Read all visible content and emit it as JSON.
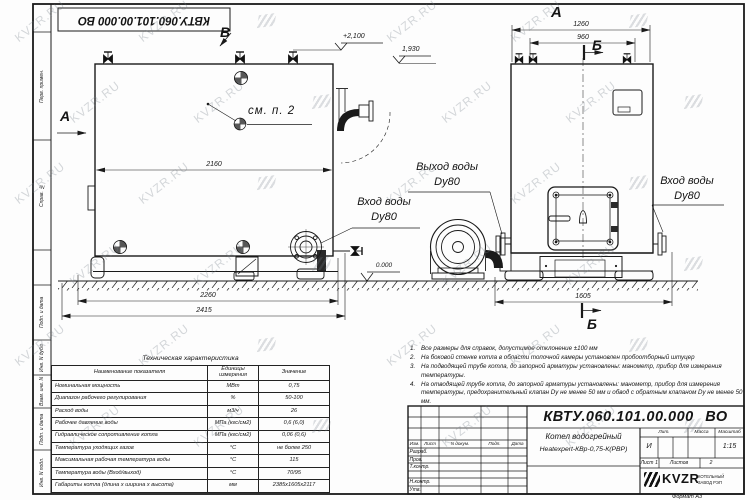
{
  "watermark": {
    "text": "KVZR.RU"
  },
  "frame": {
    "doc_number_rotated": "КВТУ.060.101.00.000  ВО",
    "strip_labels": [
      "Перв. примен.",
      "Справ. №",
      "Подп. и дата",
      "Инв. N дубл.",
      "Взам. инв. N",
      "Подп. и дата",
      "Инв. N подл."
    ],
    "format_note": "Формат  А3"
  },
  "drawing": {
    "marker_v": "В",
    "marker_a_side": "А",
    "marker_a_view": "А",
    "marker_b_top": "Б",
    "marker_b_bottom": "Б",
    "callout_see": "см. п. 2",
    "elev_plus2100": "+2,100",
    "elev_1930": "1,930",
    "elev_zero": "0.000",
    "dim_2160": "2160",
    "dim_2260": "2260",
    "dim_2415": "2415",
    "dim_1260": "1260",
    "dim_960": "960",
    "dim_1605": "1605",
    "label_inlet_front": {
      "l1": "Вход воды",
      "l2": "Dy80"
    },
    "label_outlet": {
      "l1": "Выход воды",
      "l2": "Dy80"
    },
    "label_inlet_side": {
      "l1": "Вход воды",
      "l2": "Dy80"
    }
  },
  "notes": [
    {
      "n": "1.",
      "t": "Все размеры для справок, допустимое отклонение ±100 мм"
    },
    {
      "n": "2.",
      "t": "На боковой стенке котла в области топочной камеры установлен пробоотборный штуцер"
    },
    {
      "n": "3.",
      "t": "На подводящей трубе котла, до запорной арматуры установлены: манометр, прибор для измерения температуры."
    },
    {
      "n": "4.",
      "t": "На отводящей трубе котла, до запорной арматуры установлены: манометр, прибор для измерения температуры, предохранительный клапан Dу не менее 50 мм и обвод с обратным клапаном Dу не менее 50 мм."
    }
  ],
  "spec_table": {
    "title": "Техническая характеристика",
    "col_name": "Наименование показателя",
    "col_unit": "Единицы измерения",
    "col_value": "Значение",
    "rows": [
      {
        "name": "Номинальная мощность",
        "unit": "МВт",
        "value": "0,75"
      },
      {
        "name": "Диапазон рабочего регулирования",
        "unit": "%",
        "value": "50-100"
      },
      {
        "name": "Расход воды",
        "unit": "м3/ч",
        "value": "26"
      },
      {
        "name": "Рабочее давление воды",
        "unit": "МПа (кгс/см2)",
        "value": "0,6 (6,0)"
      },
      {
        "name": "Гидравлическое сопротивление котла",
        "unit": "МПа (кгс/см2)",
        "value": "0,06 (0,6)"
      },
      {
        "name": "Температура уходящих газов",
        "unit": "°С",
        "value": "не более 250"
      },
      {
        "name": "Максимальная рабочая температура воды",
        "unit": "°С",
        "value": "115"
      },
      {
        "name": "Температура воды (Вход/выход)",
        "unit": "°С",
        "value": "70/95"
      },
      {
        "name": "Габариты котла (длина х ширина х высота)",
        "unit": "мм",
        "value": "2385х1605х2117"
      }
    ]
  },
  "title_block": {
    "doc_number": "КВТУ.060.101.00.000  ВО",
    "rev_cols": [
      "Изм.",
      "Лист",
      "N докум.",
      "Подп.",
      "Дата"
    ],
    "roles": [
      "Разраб.",
      "Пров.",
      "Т.контр.",
      "Н.контр.",
      "Утв."
    ],
    "product_line1": "Котел водогрейный",
    "product_line2": "Heatexpert-КВр-0,75-К(РВР)",
    "lit_label": "Лит.",
    "mass_label": "Масса",
    "scale_label": "Масштаб",
    "lit_value": "И",
    "scale_value": "1:15",
    "sheet_label": "Лист",
    "sheet_value": "1",
    "sheets_label": "Листов",
    "sheets_value": "2",
    "logo_text": "KVZR",
    "logo_line1": "КОТЕЛЬНЫЙ",
    "logo_line2": "ЗАВОД РЭП"
  }
}
